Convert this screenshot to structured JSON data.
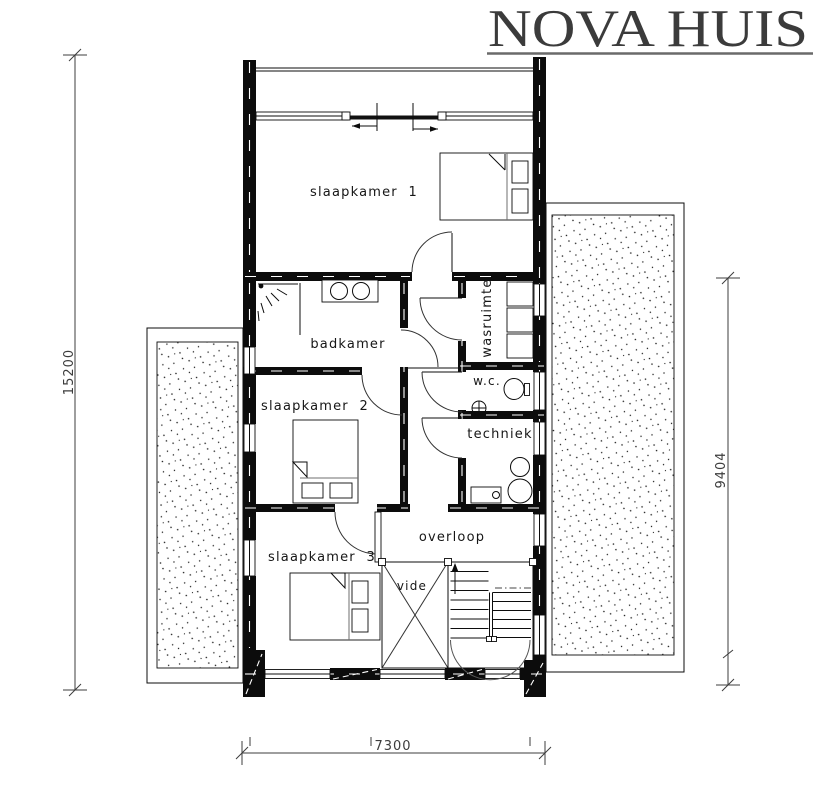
{
  "logo": {
    "text": "NOVA HUIS"
  },
  "plan": {
    "rooms": {
      "slaapkamer1": "slaapkamer  1",
      "badkamer": "badkamer",
      "wasruimte": "wasruimte",
      "wc": "w.c.",
      "slaapkamer2": "slaapkamer  2",
      "techniek": "techniek",
      "overloop": "overloop",
      "slaapkamer3": "slaapkamer  3",
      "vide": "vide"
    },
    "dimensions": {
      "left": "15200",
      "right": "9404",
      "bottom": "7300"
    },
    "fixture_icons": [
      "double-bed-icon",
      "nightstand-icon",
      "duvet-fold-icon",
      "double-washbasin-icon",
      "shower-icon",
      "shower-screen-icon",
      "washer-dryer-stack-icon",
      "toilet-icon",
      "hand-basin-icon",
      "boiler-icon",
      "water-heater-icon",
      "worktop-icon",
      "staircase-icon",
      "stair-up-arrow-icon",
      "vide-cross-icon",
      "sliding-window-arrow-icon",
      "door-swing-icon",
      "terrace-stipple"
    ]
  },
  "colors": {
    "ink": "#0c0c0c",
    "logo_ink": "#3b3b3b",
    "dim_ink": "#3c3c3c",
    "paper": "#ffffff",
    "underline_gray": "#6a6a6a"
  }
}
